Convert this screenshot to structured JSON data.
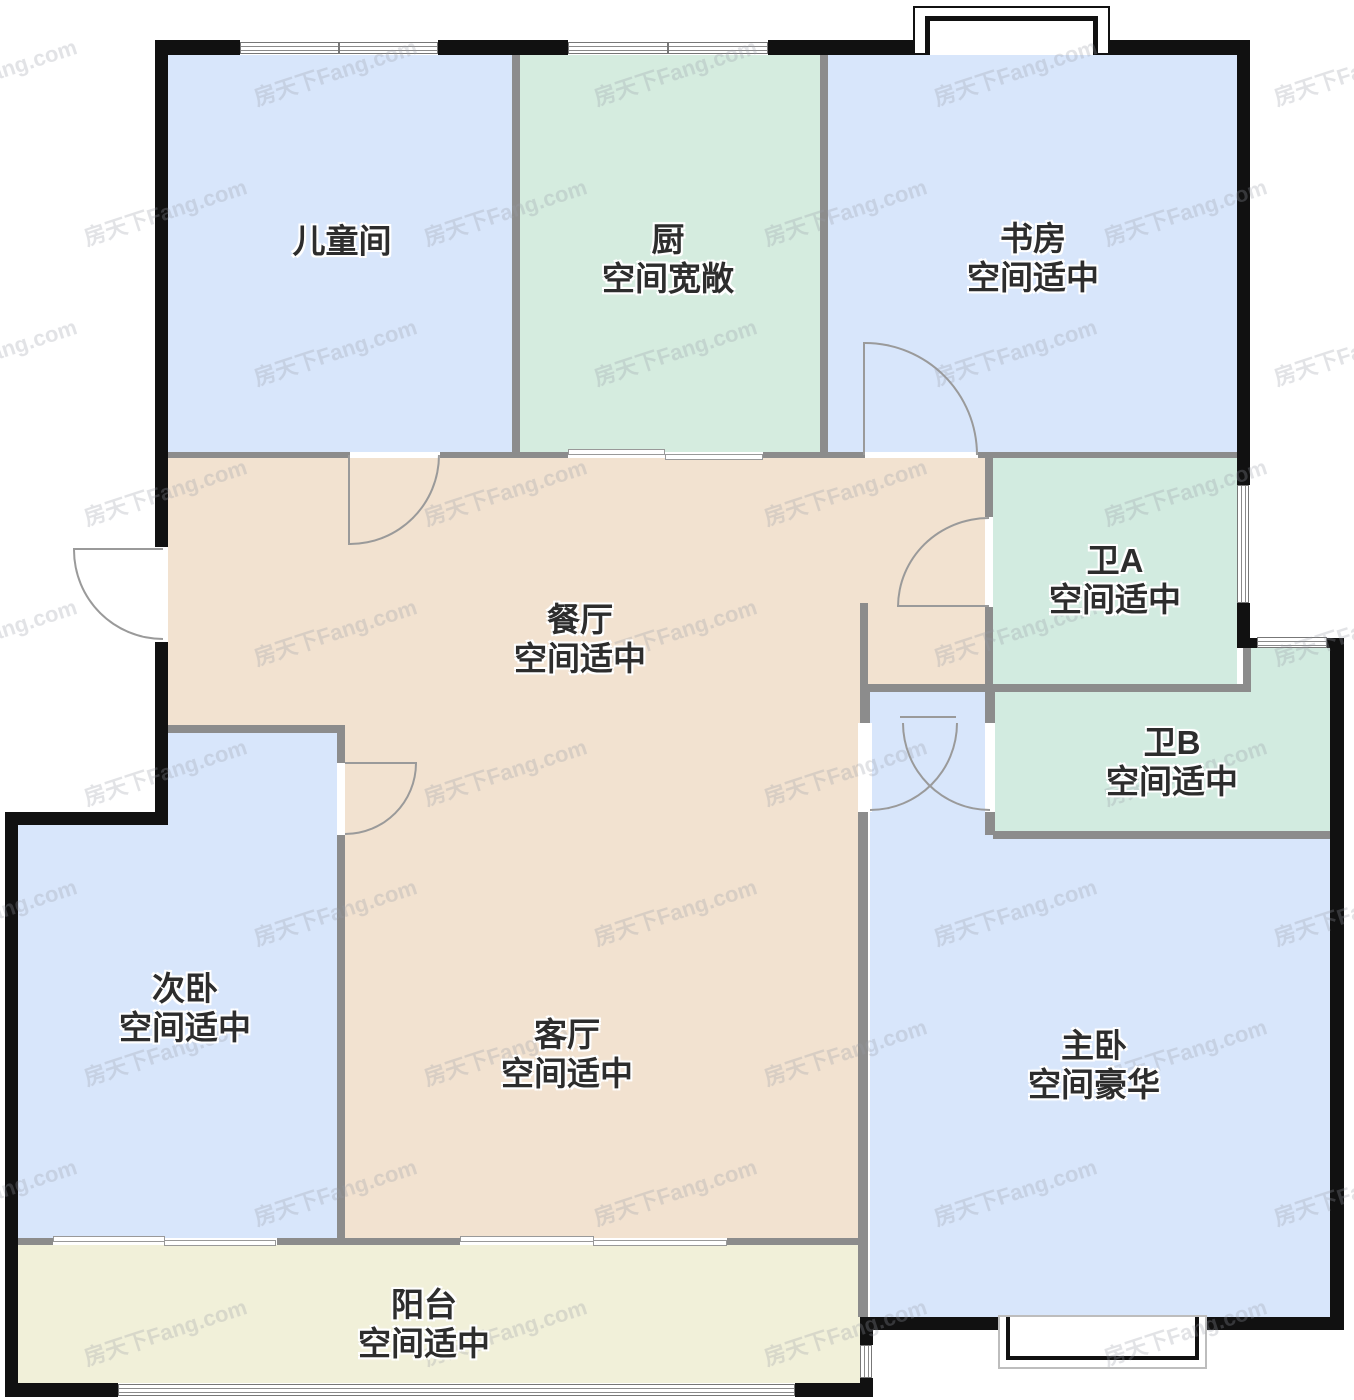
{
  "watermark": {
    "text": "房天下Fang.com"
  },
  "colors": {
    "bedroom": "#d8e6fb",
    "kitchen": "#d5ecdf",
    "bath": "#d2ebe0",
    "hall": "#f2e2d0",
    "balcony": "#f1f0d9",
    "outer_wall": "#111111",
    "inner_wall": "#8c8c8c",
    "door_stroke": "#9a9a9a",
    "label_text": "#2d2d2d"
  },
  "rooms": {
    "children_room": {
      "name": "儿童间",
      "desc": ""
    },
    "kitchen": {
      "name": "厨",
      "desc": "空间宽敞"
    },
    "study": {
      "name": "书房",
      "desc": "空间适中"
    },
    "dining": {
      "name": "餐厅",
      "desc": "空间适中"
    },
    "bath_a": {
      "name": "卫A",
      "desc": "空间适中"
    },
    "bath_b": {
      "name": "卫B",
      "desc": "空间适中"
    },
    "second_bedroom": {
      "name": "次卧",
      "desc": "空间适中"
    },
    "living": {
      "name": "客厅",
      "desc": "空间适中"
    },
    "master_bedroom": {
      "name": "主卧",
      "desc": "空间豪华"
    },
    "balcony": {
      "name": "阳台",
      "desc": "空间适中"
    }
  }
}
